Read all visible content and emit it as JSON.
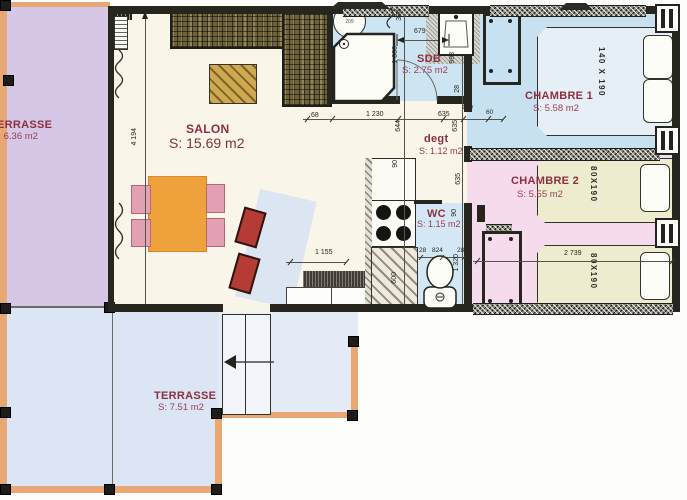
{
  "document": {
    "type": "apartment floor plan (scanned drawing)"
  },
  "rooms": {
    "terrasse_left": {
      "name": "TERRASSE",
      "area": "S: 6.36 m2"
    },
    "salon": {
      "name": "SALON",
      "area": "S: 15.69 m2"
    },
    "sdb": {
      "name": "SDB",
      "area": "S: 2.75 m2"
    },
    "degt": {
      "name": "degt",
      "area": "S: 1.12 m2"
    },
    "wc": {
      "name": "WC",
      "area": "S: 1.15 m2"
    },
    "chambre1": {
      "name": "CHAMBRE 1",
      "area": "S: 5.58 m2"
    },
    "chambre2": {
      "name": "CHAMBRE 2",
      "area": "S: 5.55 m2"
    },
    "terrasse_bottom": {
      "name": "TERRASSE",
      "area": "S: 7.51 m2"
    }
  },
  "furniture": {
    "double_bed": "140 X 190",
    "single_bed": "80X190",
    "water_heater": "209"
  },
  "dims": {
    "v4194": "4 194",
    "v396": "396",
    "v679": "679",
    "v1000": "1 000",
    "v993": "993",
    "v28": "28",
    "v68": "68",
    "v1230": "1 230",
    "v635": "635",
    "v160": "160",
    "v60": "60",
    "v644": "644",
    "v90": "90",
    "v600": "600",
    "v824": "824",
    "v1320": "1 320",
    "v1155": "1 155",
    "v2739": "2 739"
  },
  "colors": {
    "wall": "#26261f",
    "terrace_left_floor": "#d6c7e6",
    "terrace_bottom_floor": "#dbe5f4",
    "salon_floor": "#f9f5e8",
    "sdb_floor": "#cde4f2",
    "chambre1_floor": "#c8e1f0",
    "chambre2_floor": "#f5dbeb",
    "bed_single_fill": "#eeeccf",
    "label_red": "#8e2f3f",
    "terrace_border_orange": "#e8a874",
    "table_orange": "#efa23b",
    "kitchen_counter": "#6e6239"
  }
}
